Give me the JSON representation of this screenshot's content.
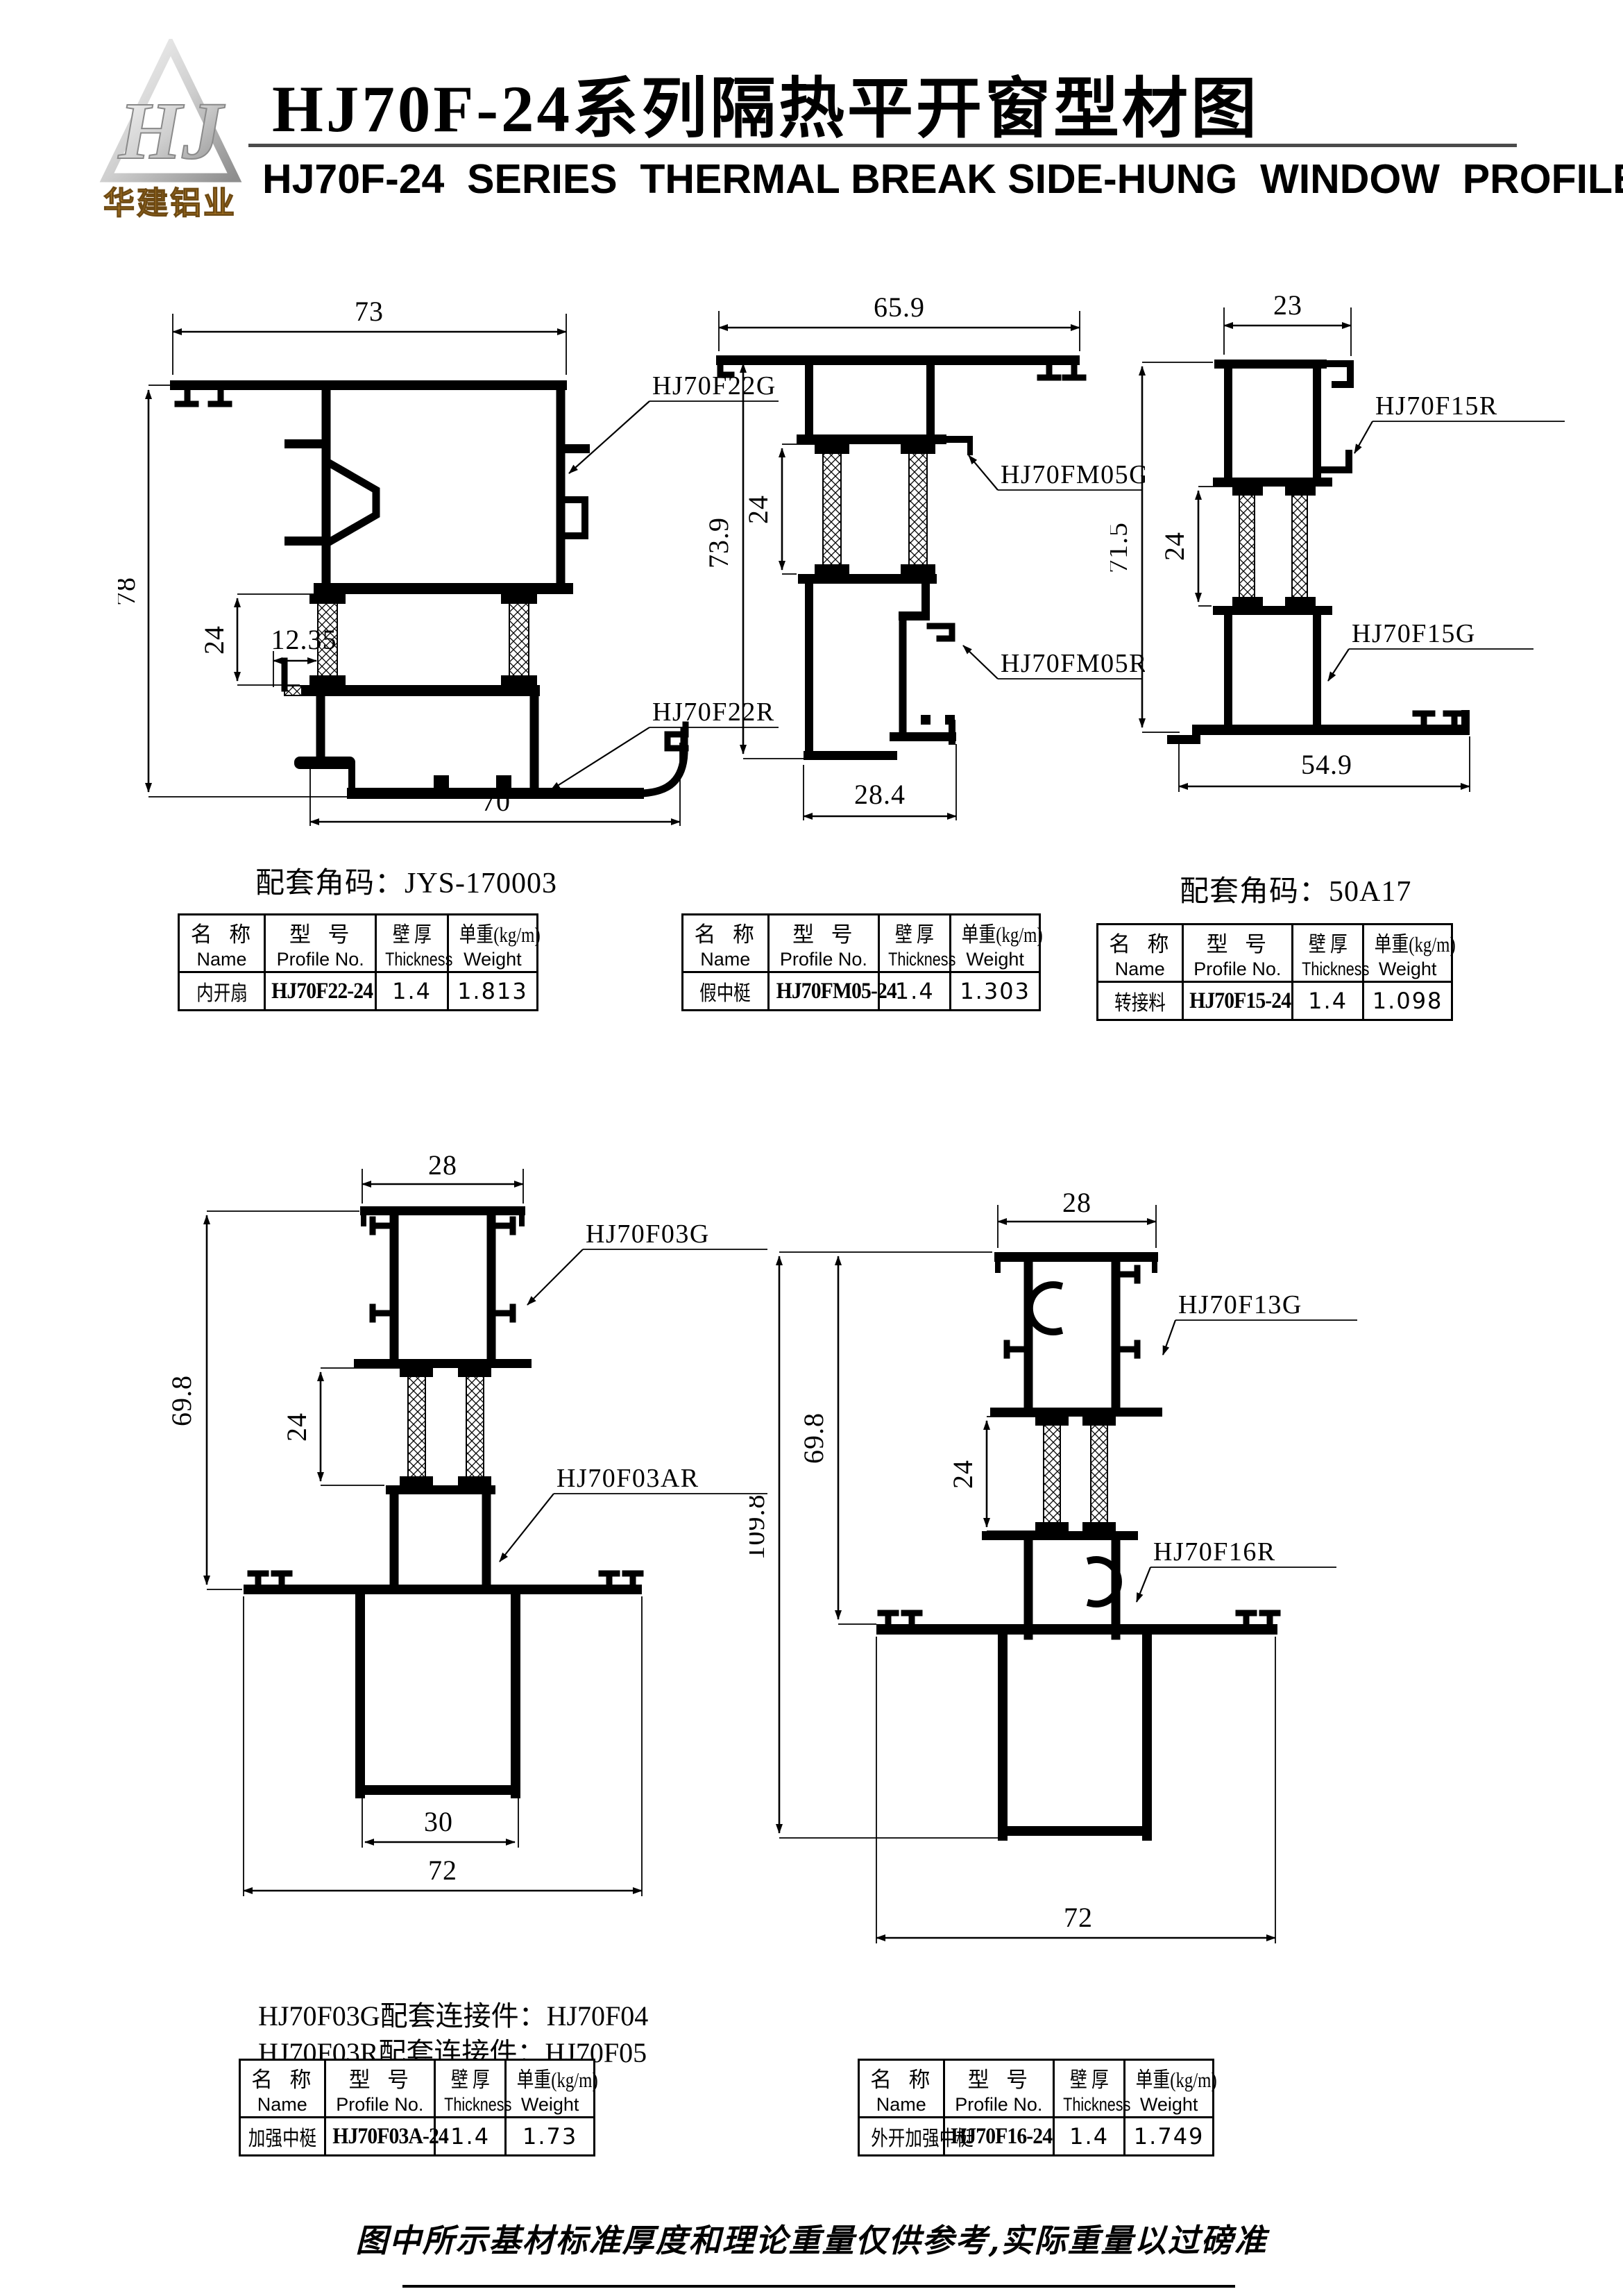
{
  "header": {
    "logo": {
      "monogram": "HJ",
      "company": "华建铝业"
    },
    "title_cn": "HJ70F-24系列隔热平开窗型材图",
    "title_en": "HJ70F-24  SERIES  THERMAL BREAK SIDE-HUNG  WINDOW  PROFILES"
  },
  "table_header": {
    "name_cn": "名  称",
    "name_en": "Name",
    "model_cn": "型  号",
    "model_en": "Profile No.",
    "thickness_cn": "壁  厚",
    "thickness_en": "Thickness",
    "weight_cn": "单重(kg/m)",
    "weight_en": "Weight"
  },
  "sections": [
    {
      "caption": "配套角码：JYS-170003",
      "labels": {
        "a": "HJ70F22G",
        "b": "HJ70F22R"
      },
      "dims": {
        "top": "73",
        "left": "78",
        "mid": "24",
        "inner": "12.35",
        "bottom": "70"
      },
      "row": {
        "name": "内开扇",
        "model": "HJ70F22-24",
        "thickness": "1.4",
        "weight": "1.813"
      }
    },
    {
      "labels": {
        "a": "HJ70FM05G",
        "b": "HJ70FM05R"
      },
      "dims": {
        "top": "65.9",
        "left": "73.9",
        "mid": "24",
        "bottom": "28.4"
      },
      "row": {
        "name": "假中梃",
        "model": "HJ70FM05-24",
        "thickness": "1.4",
        "weight": "1.303"
      }
    },
    {
      "caption": "配套角码：50A17",
      "labels": {
        "a": "HJ70F15R",
        "b": "HJ70F15G"
      },
      "dims": {
        "top": "23",
        "left": "71.5",
        "mid": "24",
        "bottom": "54.9"
      },
      "row": {
        "name": "转接料",
        "model": "HJ70F15-24",
        "thickness": "1.4",
        "weight": "1.098"
      }
    },
    {
      "notes": [
        "HJ70F03G配套连接件：HJ70F04",
        "HJ70F03R配套连接件：HJ70F05"
      ],
      "labels": {
        "a": "HJ70F03G",
        "b": "HJ70F03AR"
      },
      "dims": {
        "top": "28",
        "left": "69.8",
        "mid": "24",
        "inner": "30",
        "bottom": "72"
      },
      "row": {
        "name": "加强中梃",
        "model": "HJ70F03A-24",
        "thickness": "1.4",
        "weight": "1.73"
      }
    },
    {
      "labels": {
        "a": "HJ70F13G",
        "b": "HJ70F16R"
      },
      "dims": {
        "top": "28",
        "outer": "109.8",
        "left": "69.8",
        "mid": "24",
        "bottom": "72"
      },
      "row": {
        "name": "外开加强中梃",
        "model": "HJ70F16-24",
        "thickness": "1.4",
        "weight": "1.749"
      }
    }
  ],
  "footer": {
    "note": "图中所示基材标准厚度和理论重量仅供参考,实际重量以过磅准"
  }
}
